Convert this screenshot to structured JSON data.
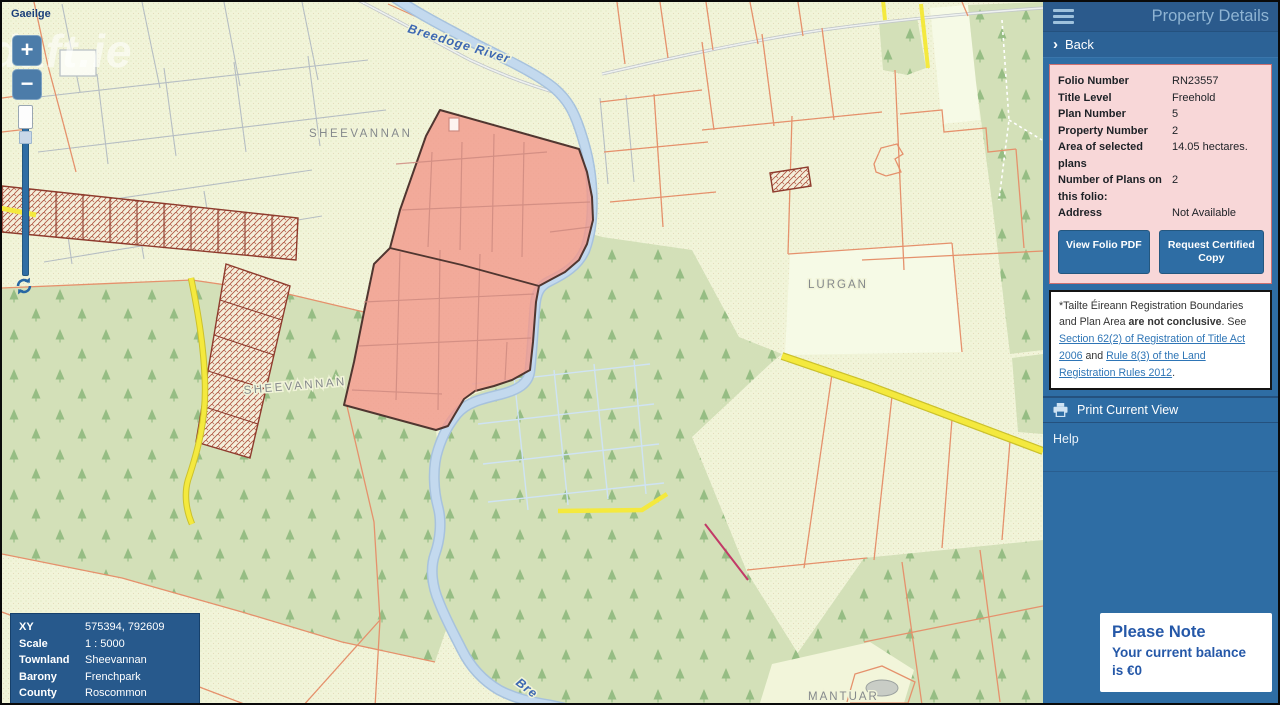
{
  "map": {
    "language_link": "Gaeilge",
    "watermark": "daft.ie",
    "controls": {
      "zoom_in": "+",
      "zoom_out": "−"
    },
    "labels": {
      "river": "Breedoge River",
      "river_partial": "Bre",
      "townland_1": "SHEEVANNAN",
      "townland_2": "SHEEVANNAN",
      "townland_3": "LURGAN",
      "townland_4": "MANTUAR"
    }
  },
  "info_box": {
    "rows": [
      {
        "label": "XY",
        "value": "575394, 792609"
      },
      {
        "label": "Scale",
        "value": "1 : 5000"
      },
      {
        "label": "Townland",
        "value": "Sheevannan"
      },
      {
        "label": "Barony",
        "value": "Frenchpark"
      },
      {
        "label": "County",
        "value": "Roscommon"
      }
    ]
  },
  "panel": {
    "title": "Property Details",
    "back_label": "Back",
    "details": {
      "rows": [
        {
          "label": "Folio Number",
          "value": "RN23557"
        },
        {
          "label": "Title Level",
          "value": "Freehold"
        },
        {
          "label": "Plan Number",
          "value": "5"
        },
        {
          "label": "Property Number",
          "value": "2"
        },
        {
          "label": "Area of selected plans",
          "value": "14.05 hectares."
        },
        {
          "label": "Number of Plans on this folio:",
          "value": "2"
        },
        {
          "label": "Address",
          "value": "Not Available"
        }
      ],
      "buttons": {
        "view_folio_pdf": "View Folio PDF",
        "request_certified_copy": "Request Certified Copy"
      }
    },
    "disclaimer": {
      "text_1": "*Tailte Éireann Registration Boundaries and Plan Area ",
      "bold": "are not conclusive",
      "text_2": ". See ",
      "link_1": "Section 62(2) of Registration of Title Act 2006",
      "text_3": " and ",
      "link_2": "Rule 8(3) of the Land Registration Rules 2012",
      "text_4": "."
    },
    "print_label": "Print Current View",
    "help_label": "Help",
    "notice": {
      "title": "Please Note",
      "body": "Your current balance is €0"
    }
  },
  "colors": {
    "panel_blue": "#2e6da4",
    "header_blue": "#2b5a8c",
    "highlight_pink": "#f19a8c",
    "road_yellow": "#f4e93e",
    "river_blue": "#c3d9ee",
    "boundary_orange": "#e5916c",
    "forest_green": "#d3e0b8"
  }
}
